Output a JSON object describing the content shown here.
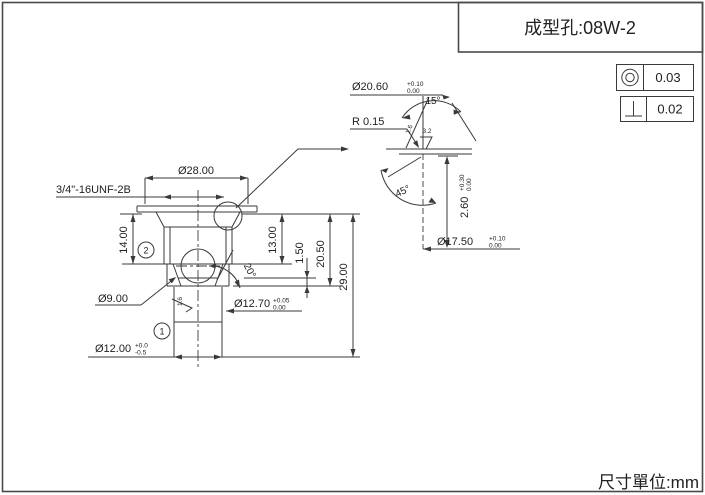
{
  "title_block": {
    "title": "成型孔:08W-2"
  },
  "page": {
    "units_label": "尺寸單位:mm"
  },
  "tolerances": {
    "concentricity": {
      "symbol_name": "concentricity-icon",
      "value": "0.03"
    },
    "perpendicularity": {
      "symbol_name": "perpendicularity-icon",
      "value": "0.02"
    }
  },
  "main_view": {
    "thread_label": "3/4\"-16UNF-2B",
    "dia_flange": "Ø28.00",
    "height_14": "14.00",
    "height_13": "13.00",
    "height_1_50": "1.50",
    "height_20_50": "20.50",
    "height_29": "29.00",
    "dia_9": "Ø9.00",
    "dia_12_70": {
      "value": "Ø12.70",
      "tol_up": "+0.05",
      "tol_dn": "0.00"
    },
    "dia_12_00": {
      "value": "Ø12.00",
      "tol_up": "+0.0",
      "tol_dn": "-0.5"
    },
    "angle_20": "20°",
    "balloon_1": "1",
    "balloon_2": "2",
    "roughness_1_6": "1.6"
  },
  "detail_view": {
    "dia_20_60": {
      "value": "Ø20.60",
      "tol_up": "+0.10",
      "tol_dn": "0.00"
    },
    "radius": "R 0.15",
    "angle_15": "15°",
    "angle_45": "45°",
    "roughness_fine": "1.6",
    "roughness_coarse": "3.2",
    "height_2_60": {
      "value": "2.60",
      "tol_up": "+0.30",
      "tol_dn": "0.00"
    },
    "dia_17_50": {
      "value": "Ø17.50",
      "tol_up": "+0.10",
      "tol_dn": "0.00"
    }
  }
}
